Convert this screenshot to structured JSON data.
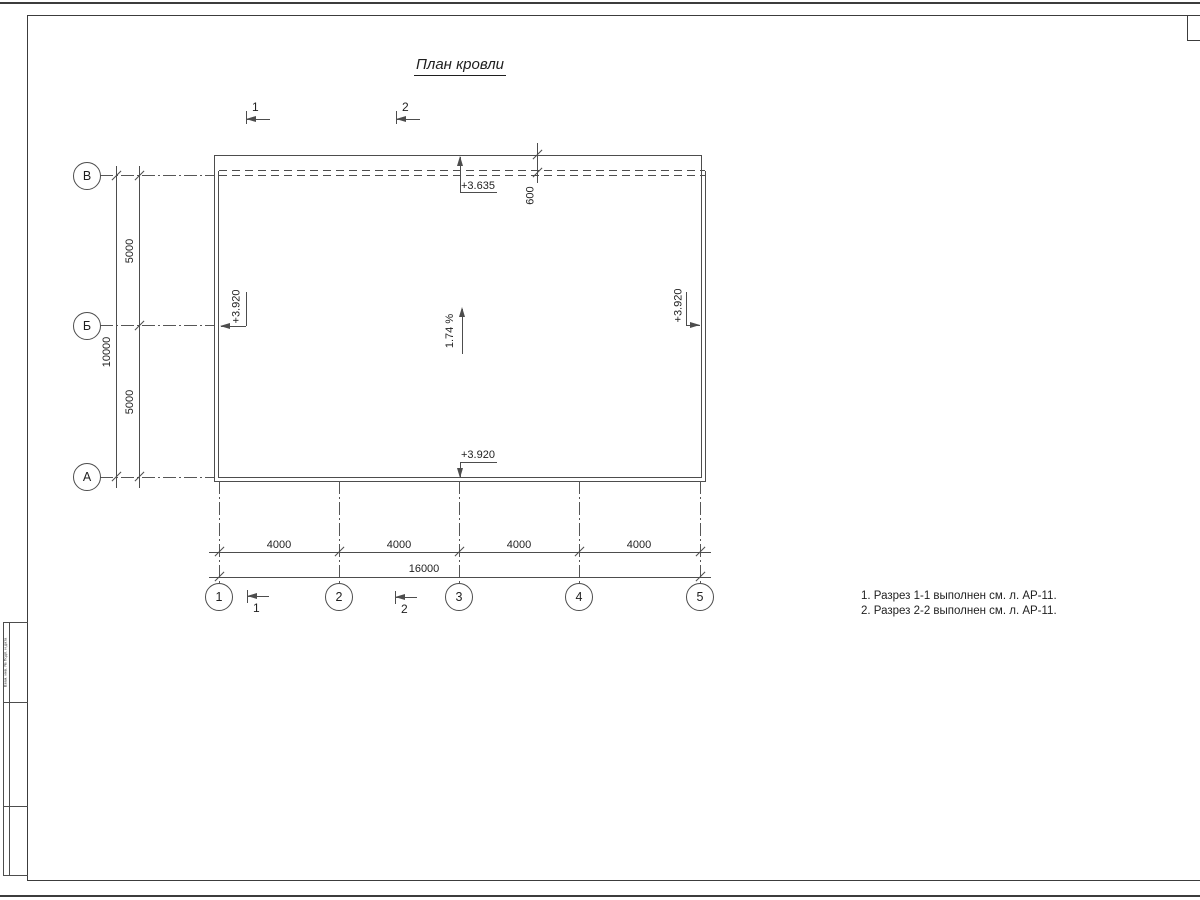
{
  "title": "План кровли",
  "axes": {
    "rows": [
      "В",
      "Б",
      "А"
    ],
    "cols": [
      "1",
      "2",
      "3",
      "4",
      "5"
    ]
  },
  "dims": {
    "left_total": "10000",
    "left_segments": [
      "5000",
      "5000"
    ],
    "bottom_segments": [
      "4000",
      "4000",
      "4000",
      "4000"
    ],
    "bottom_total": "16000",
    "overhang": "600"
  },
  "elevations": {
    "top": "+3.635",
    "left": "+3.920",
    "right": "+3.920",
    "bottom": "+3.920"
  },
  "slope": {
    "label": "1.74 %"
  },
  "sections": {
    "top": [
      "1",
      "2"
    ],
    "bottom": [
      "1",
      "2"
    ]
  },
  "notes": [
    "1. Разрез 1-1 выполнен см. л. АР-11.",
    "2. Разрез 2-2 выполнен см. л. АР-11."
  ],
  "sheet": {
    "stamp_side_text": "Взам. инв. №  Подп. и дата"
  },
  "colors": {
    "line": "#4d4d4d",
    "text": "#1f1f1f",
    "background": "#ffffff"
  }
}
